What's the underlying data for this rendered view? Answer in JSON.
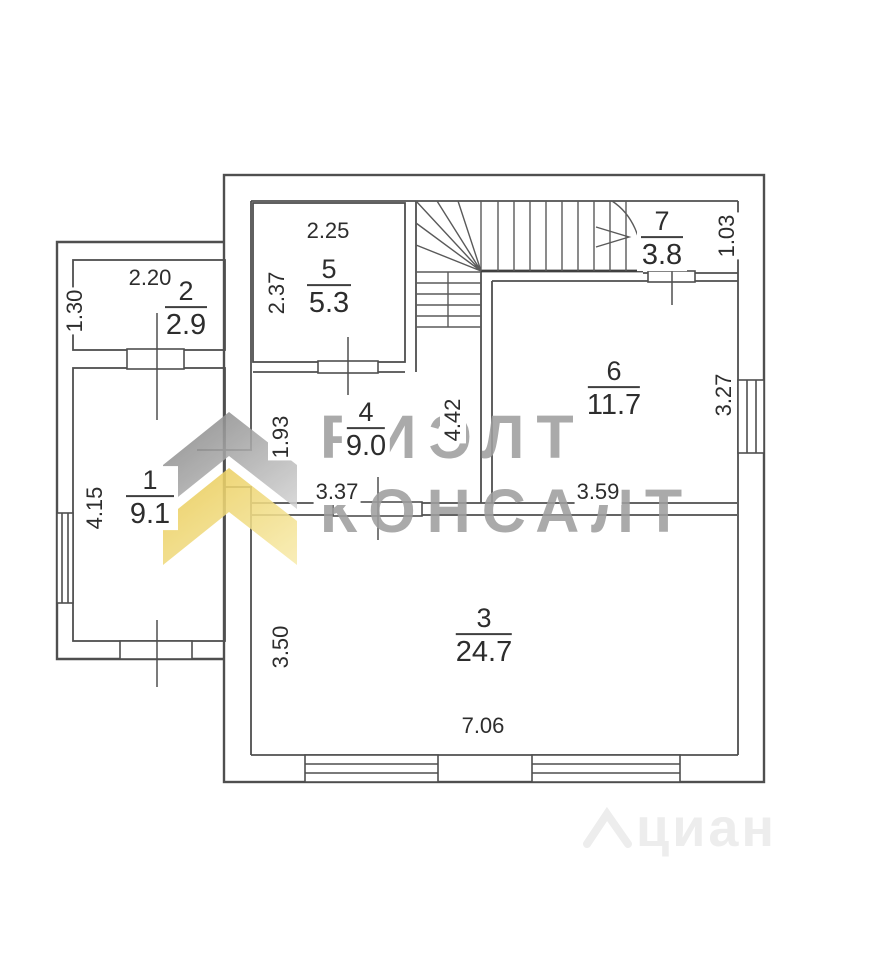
{
  "watermark": {
    "brand_line1": "РИЭЛТ",
    "brand_line2": "КОНСАЛТ",
    "brand_color": "#9e9e9e",
    "chevron_gray": "#8a8a8a",
    "chevron_yellow": "#eecf58",
    "footer_logo": "циан",
    "footer_color": "#ededed"
  },
  "plan": {
    "line_color": "#4f4f4f",
    "background": "#ffffff",
    "text_color": "#2d2d2d"
  },
  "rooms": [
    {
      "number": "1",
      "area": "9.1"
    },
    {
      "number": "2",
      "area": "2.9"
    },
    {
      "number": "3",
      "area": "24.7"
    },
    {
      "number": "4",
      "area": "9.0"
    },
    {
      "number": "5",
      "area": "5.3"
    },
    {
      "number": "6",
      "area": "11.7"
    },
    {
      "number": "7",
      "area": "3.8"
    }
  ],
  "dimensions": [
    {
      "value": "2.20"
    },
    {
      "value": "1.30"
    },
    {
      "value": "2.25"
    },
    {
      "value": "2.37"
    },
    {
      "value": "1.03"
    },
    {
      "value": "4.15"
    },
    {
      "value": "1.93"
    },
    {
      "value": "4.42"
    },
    {
      "value": "3.37"
    },
    {
      "value": "3.59"
    },
    {
      "value": "3.27"
    },
    {
      "value": "3.50"
    },
    {
      "value": "7.06"
    }
  ]
}
